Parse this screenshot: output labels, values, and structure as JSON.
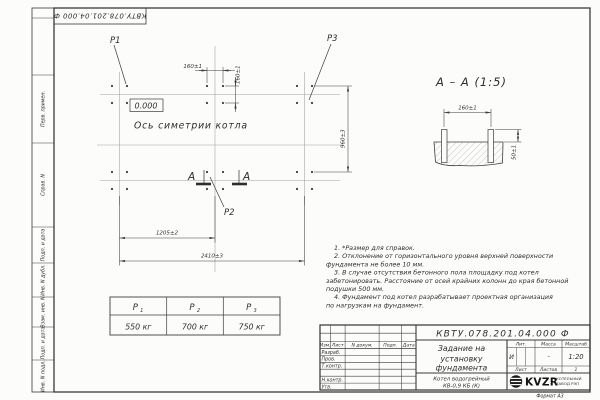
{
  "sheet": {
    "designation": "КВТУ.078.201.04.000 Ф",
    "format_note": "Формат А3"
  },
  "margin_labels": [
    "Перв. примен.",
    "Справ. N",
    "Подп. и дата",
    "Инв. N дубл.",
    "Взам. инв. N",
    "Подп. и дата",
    "Инв. N подл."
  ],
  "plan": {
    "label_p1": "P1",
    "label_p2": "P2",
    "label_p3": "P3",
    "elevation": "0.000",
    "axis_caption": "Ось симетрии котла",
    "section_letter": "А",
    "dim_bolt_h": "160±1",
    "dim_bolt_v": "160±1",
    "dim_rows": "960±3",
    "dim_half": "1205±2",
    "dim_total": "2410±3"
  },
  "section_view": {
    "title": "А – А (1:5)",
    "dim_width": "160±1",
    "dim_height": "50±1"
  },
  "notes_lines": [
    "1. *Размер для справок.",
    "2. Отклонение от горизонтального уровня верхней поверхности",
    "фундамента не более 10 мм.",
    "3. В случае отсутствия бетонного пола площадку под котел",
    "забетонировать. Расстояние от осей крайних колонн до края бетонной",
    "подушки 500 мм.",
    "4. Фундамент под котел разрабатывает проектная организация",
    "по нагрузкам на фундамент."
  ],
  "load_table": {
    "columns": [
      {
        "name": "P",
        "sub": "1",
        "value": "550 кг"
      },
      {
        "name": "P",
        "sub": "2",
        "value": "700 кг"
      },
      {
        "name": "P",
        "sub": "3",
        "value": "750 кг"
      }
    ]
  },
  "title_block": {
    "designation": "КВТУ.078.201.04.000 Ф",
    "doc_title_lines": [
      "Задание на",
      "установку",
      "фундамента"
    ],
    "product_lines": [
      "Котел водогрейный",
      "КВ-0,9 КБ (К)"
    ],
    "col_headers": [
      "Изм.",
      "Лист",
      "N докум.",
      "Подп.",
      "Дата"
    ],
    "row_labels": [
      "Разраб.",
      "Пров.",
      "Т.контр.",
      "Н.контр.",
      "Утв."
    ],
    "lit_header": "Лит.",
    "mass_header": "Масса",
    "scale_header": "Масштаб",
    "lit_value": "И",
    "mass_value": "-",
    "scale_value": "1:20",
    "sheet_label": "Лист",
    "sheets_label": "Листов",
    "sheets_value": "1",
    "logo_text": "KVZR",
    "logo_sub_lines": [
      "КОТЕЛЬНЫЙ",
      "ЗАВОД РЭП"
    ]
  }
}
